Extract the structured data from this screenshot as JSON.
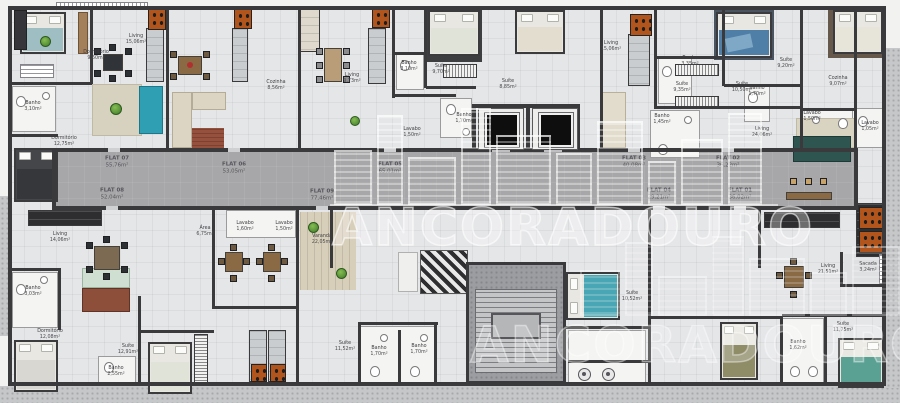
{
  "watermarks": {
    "primary": "ANCORADOURO",
    "secondary": "ANCORADOURO"
  },
  "corridor_flats": [
    {
      "name": "FLAT 07",
      "area": "55,76m²"
    },
    {
      "name": "FLAT 06",
      "area": "53,05m²"
    },
    {
      "name": "FLAT 05",
      "area": "65,01m²"
    },
    {
      "name": "FLAT 03",
      "area": "40,08m²"
    },
    {
      "name": "FLAT 02",
      "area": "36,22m²"
    },
    {
      "name": "FLAT 08",
      "area": "52,04m²"
    },
    {
      "name": "FLAT 09",
      "area": "77,46m²"
    },
    {
      "name": "FLAT 04",
      "area": "29,21m²"
    },
    {
      "name": "FLAT 01",
      "area": "36,02m²"
    }
  ],
  "room_labels": [
    {
      "name": "Dormitório",
      "area": "9,60m²"
    },
    {
      "name": "Living",
      "area": "15,06m²"
    },
    {
      "name": "Banho",
      "area": "3,10m²"
    },
    {
      "name": "Dormitório",
      "area": "12,75m²"
    },
    {
      "name": "Cozinha",
      "area": "8,56m²"
    },
    {
      "name": "Living",
      "area": "9,73m²"
    },
    {
      "name": "Banho",
      "area": "3,10m²"
    },
    {
      "name": "Suíte",
      "area": "9,70m²"
    },
    {
      "name": "Suíte",
      "area": "8,85m²"
    },
    {
      "name": "Lavabo",
      "area": "1,50m²"
    },
    {
      "name": "Banho",
      "area": "1,70m²"
    },
    {
      "name": "Living",
      "area": "15,06m²"
    },
    {
      "name": "Banho",
      "area": "3,35m²"
    },
    {
      "name": "Suíte",
      "area": "9,35m²"
    },
    {
      "name": "Suíte",
      "area": "10,50m²"
    },
    {
      "name": "Suíte",
      "area": "9,20m²"
    },
    {
      "name": "Banho",
      "area": "1,70m²"
    },
    {
      "name": "Lavabo",
      "area": "1,50m²"
    },
    {
      "name": "Cozinha",
      "area": "9,07m²"
    },
    {
      "name": "Lavabo",
      "area": "1,05m²"
    },
    {
      "name": "Living",
      "area": "14,06m²"
    },
    {
      "name": "Banho",
      "area": "3,03m²"
    },
    {
      "name": "Área",
      "area": "6,75m²"
    },
    {
      "name": "Dormitório",
      "area": "12,08m²"
    },
    {
      "name": "Suíte",
      "area": "12,91m²"
    },
    {
      "name": "Lavabo",
      "area": "1,60m²"
    },
    {
      "name": "Lavabo",
      "area": "1,50m²"
    },
    {
      "name": "Varanda",
      "area": "22,05m²"
    },
    {
      "name": "Living",
      "area": "24,06m²"
    },
    {
      "name": "Suíte",
      "area": "10,52m²"
    },
    {
      "name": "Banho",
      "area": "2,55m²"
    },
    {
      "name": "Suíte",
      "area": "11,52m²"
    },
    {
      "name": "Banho",
      "area": "1,70m²"
    },
    {
      "name": "Banho",
      "area": "1,70m²"
    },
    {
      "name": "Suíte",
      "area": "11,75m²"
    },
    {
      "name": "Banho",
      "area": "1,62m²"
    },
    {
      "name": "Sacada",
      "area": "3,24m²"
    },
    {
      "name": "Living",
      "area": "21,51m²"
    },
    {
      "name": "Banho",
      "area": "1,45m²"
    }
  ]
}
